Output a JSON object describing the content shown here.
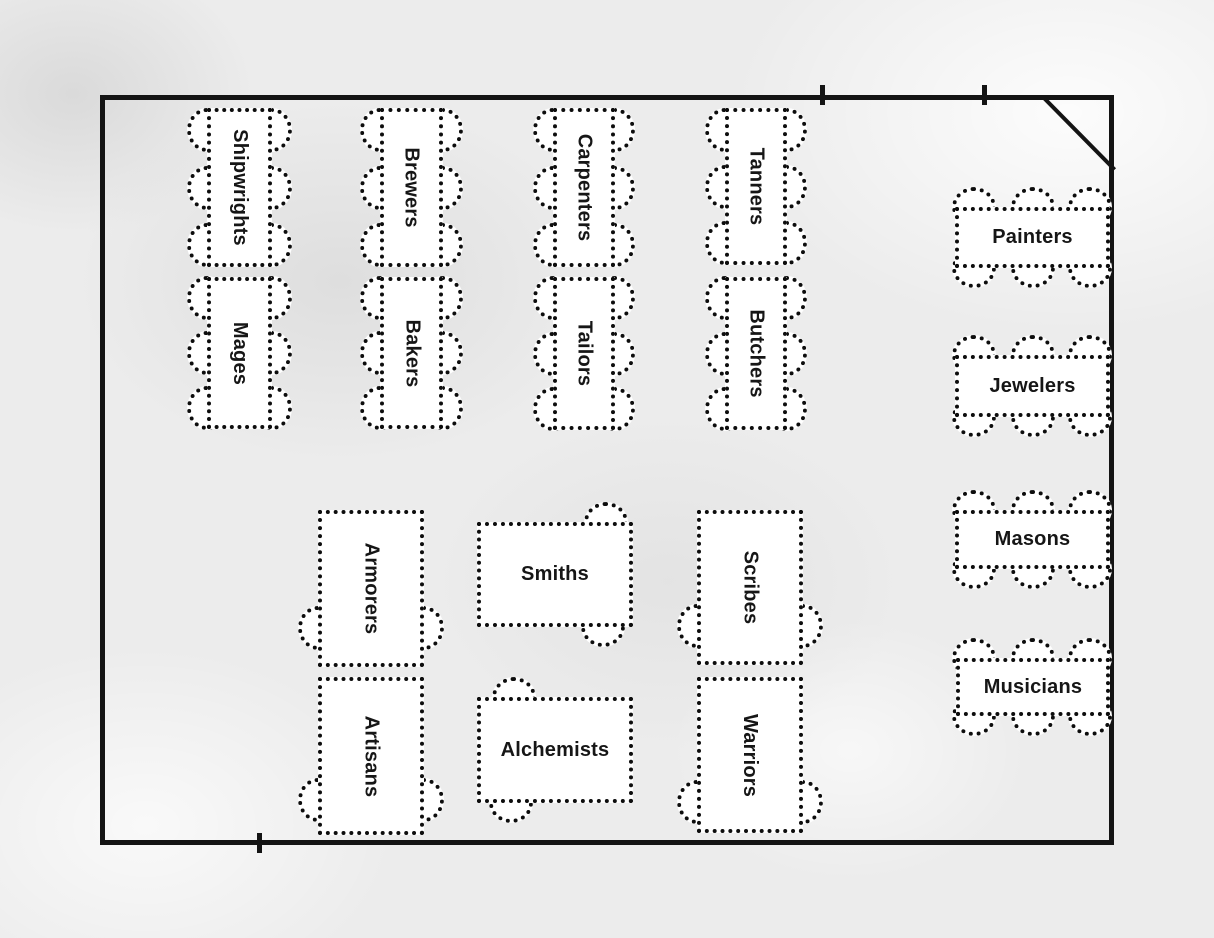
{
  "diagram": {
    "kind": "banquet-seating-floor-plan",
    "colors": {
      "background": "#ececec",
      "wall": "#141414",
      "table_border": "#0d0d0d",
      "table_fill": "#ffffff",
      "label_text": "#161616"
    },
    "features": {
      "door_marker": "diagonal-door-swing-top-right-corner",
      "wall_marks": [
        "top-wall-tick-left",
        "top-wall-tick-right",
        "bottom-wall-tick"
      ]
    },
    "tables": {
      "shipwrights": {
        "label": "Shipwrights"
      },
      "mages": {
        "label": "Mages"
      },
      "brewers": {
        "label": "Brewers"
      },
      "bakers": {
        "label": "Bakers"
      },
      "carpenters": {
        "label": "Carpenters"
      },
      "tailors": {
        "label": "Tailors"
      },
      "tanners": {
        "label": "Tanners"
      },
      "butchers": {
        "label": "Butchers"
      },
      "painters": {
        "label": "Painters"
      },
      "jewelers": {
        "label": "Jewelers"
      },
      "masons": {
        "label": "Masons"
      },
      "musicians": {
        "label": "Musicians"
      },
      "armorers": {
        "label": "Armorers"
      },
      "artisans": {
        "label": "Artisans"
      },
      "smiths": {
        "label": "Smiths"
      },
      "alchemists": {
        "label": "Alchemists"
      },
      "scribes": {
        "label": "Scribes"
      },
      "warriors": {
        "label": "Warriors"
      }
    }
  }
}
